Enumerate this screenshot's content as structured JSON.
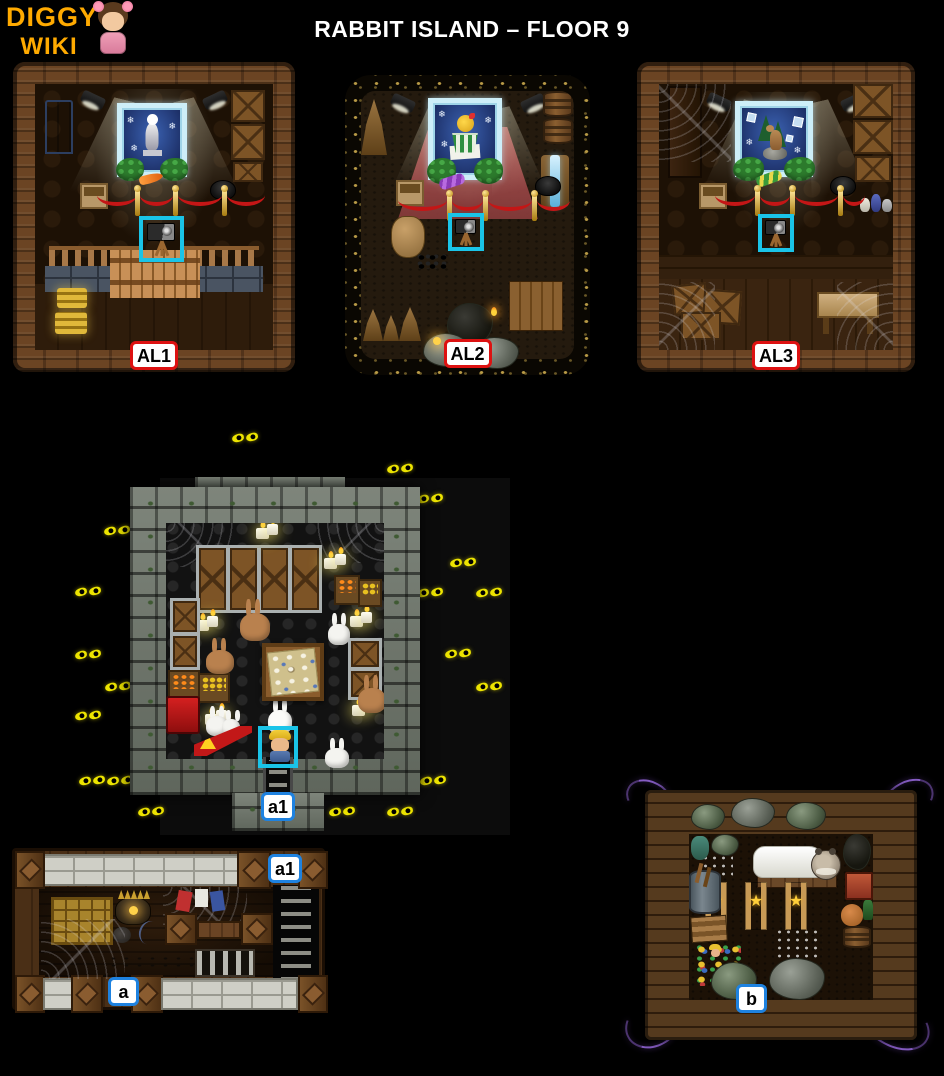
{
  "header": {
    "logo_line1": "DIGGY'S",
    "logo_line2": "WIKI",
    "title": "RABBIT ISLAND – FLOOR 9"
  },
  "glyphs": {
    "snowflake": "❄",
    "star": "★"
  },
  "colors": {
    "background": "#000000",
    "logo_text": "#ffaa00",
    "title_text": "#ffffff",
    "red_label_border": "#dd1111",
    "blue_label_border": "#1e82e0",
    "highlight_box": "#1ac4e8",
    "eyes": "#ede400",
    "stone": "#7e857b",
    "wood": "#6b4423"
  },
  "rooms": {
    "al1": {
      "label": "AL1",
      "theme": "wooden-gallery",
      "objects": [
        "ice-framed-painting-snowman-statue",
        "spotlights",
        "blue-display-cabinet",
        "stacked-crates",
        "cardboard-box",
        "black-kettle",
        "velvet-rope-barrier",
        "camera-on-tripod-highlighted",
        "wooden-balustrade",
        "stone-brick-wall",
        "wooden-fence",
        "gold-bars"
      ]
    },
    "al2": {
      "label": "AL2",
      "theme": "cave-gallery",
      "objects": [
        "ice-framed-painting-chick-in-cup",
        "red-carpet",
        "spotlights",
        "stacked-barrels",
        "stalagmites",
        "waterfall",
        "sack-of-gold",
        "cardboard-box",
        "black-kettle",
        "velvet-rope-barrier",
        "camera-on-tripod-highlighted",
        "coal-pieces",
        "wooden-planks",
        "torch",
        "rocks",
        "lantern"
      ]
    },
    "al3": {
      "label": "AL3",
      "theme": "wooden-gallery",
      "objects": [
        "ice-framed-painting-goat-on-rock",
        "spotlights",
        "wooden-door",
        "cobwebs",
        "stacked-crates",
        "cardboard-box",
        "black-kettle",
        "pottery",
        "velvet-rope-barrier",
        "camera-on-tripod-highlighted",
        "wooden-floor",
        "crate-pile",
        "craft-table"
      ]
    },
    "a1": {
      "label": "a1",
      "theme": "stone-rabbit-chamber",
      "objects": [
        "glowing-eyes-in-darkness",
        "stone-chamber",
        "crate-stalls",
        "candles",
        "vegetable-crates",
        "brown-rabbits",
        "white-rabbits",
        "map-table-with-eggs",
        "red-mine-machine",
        "warning-sign",
        "diggy-character-highlighted",
        "ladder-exit"
      ],
      "eyes": [
        [
          170,
          18
        ],
        [
          325,
          49
        ],
        [
          355,
          79
        ],
        [
          42,
          111
        ],
        [
          388,
          143
        ],
        [
          13,
          172
        ],
        [
          355,
          173
        ],
        [
          414,
          173
        ],
        [
          13,
          235
        ],
        [
          383,
          234
        ],
        [
          43,
          267
        ],
        [
          414,
          267
        ],
        [
          13,
          296
        ],
        [
          17,
          361
        ],
        [
          45,
          361
        ],
        [
          358,
          361
        ],
        [
          76,
          392
        ],
        [
          267,
          392
        ],
        [
          325,
          392
        ]
      ]
    },
    "a": {
      "label": "a",
      "exit_label": "a1",
      "theme": "wooden-storage",
      "objects": [
        "white-brick-wall",
        "wooden-pillars",
        "golden-drawer-cabinet",
        "spiked-pot",
        "cobwebs",
        "hanging-clothes",
        "wooden-beams",
        "metal-grate",
        "stair-shaft",
        "footprints"
      ]
    },
    "b": {
      "label": "b",
      "theme": "wooden-den",
      "objects": [
        "purple-glowing-vines",
        "wooden-brick-walls",
        "sleeping-creature-in-bed",
        "star-trophy-posts",
        "barrels-and-junk",
        "rock-piles",
        "white-droppings",
        "colorful-scrap-pile"
      ]
    }
  }
}
